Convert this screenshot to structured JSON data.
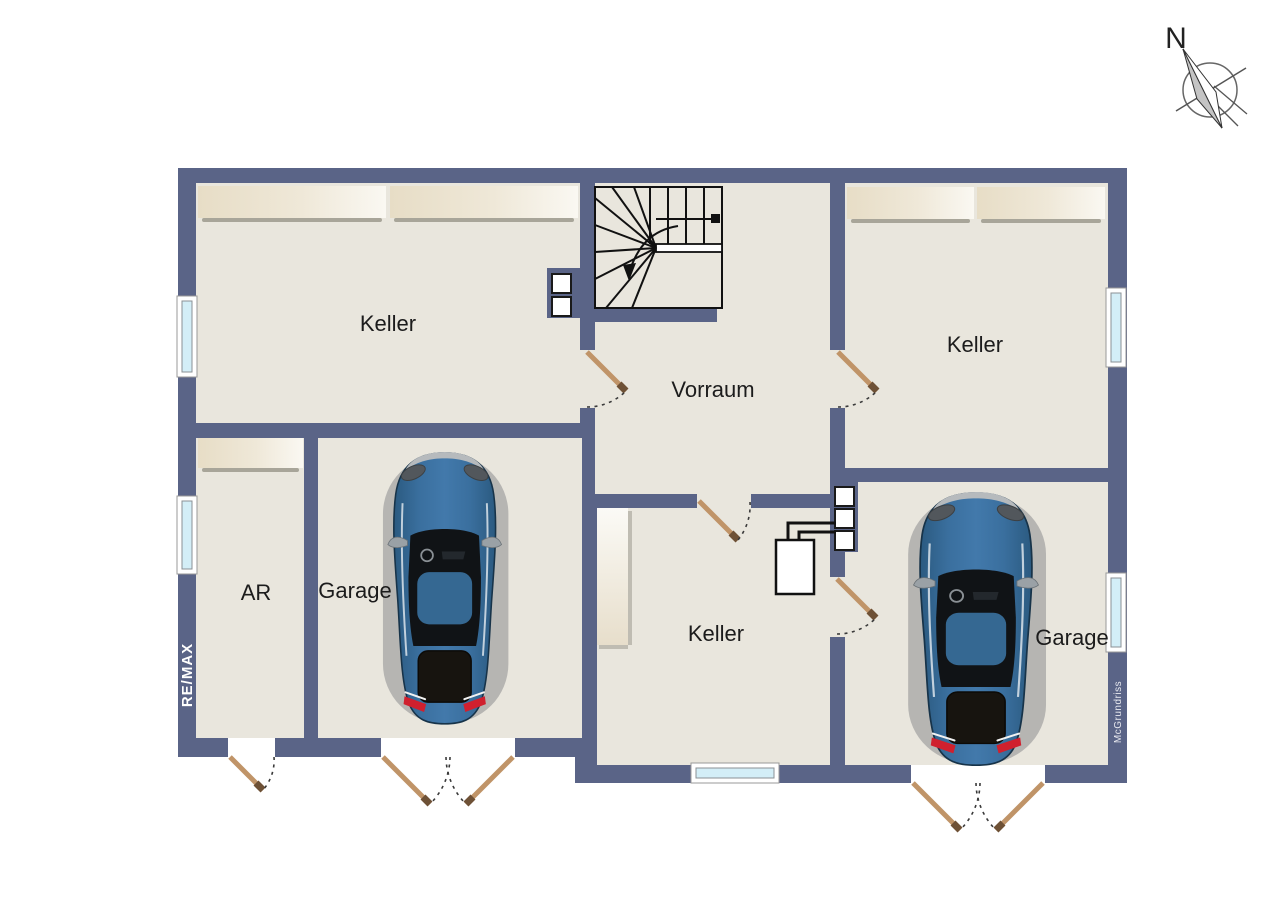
{
  "compass": {
    "north_label": "N"
  },
  "watermarks": {
    "left_wall": "RE/MAX",
    "right_wall": "McGrundriss"
  },
  "rooms": {
    "keller_top_left": "Keller",
    "keller_top_right": "Keller",
    "vorraum": "Vorraum",
    "keller_middle": "Keller",
    "ar": "AR",
    "garage_left": "Garage",
    "garage_right": "Garage"
  },
  "palette": {
    "wall": "#5a6487",
    "floor": "#e9e6dd",
    "closet_beige": "#e8dfcc",
    "window_glass": "#d3eef7",
    "door_leaf": "#c09468",
    "car_body": "#34688f",
    "taillight_red": "#d0202e"
  }
}
